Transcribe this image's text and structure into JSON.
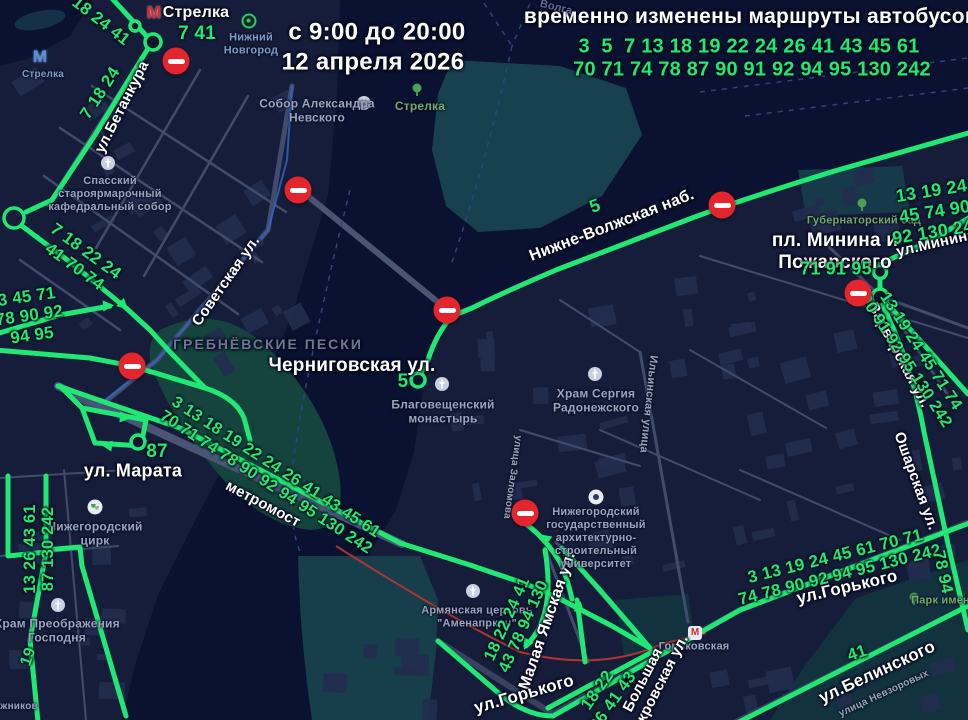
{
  "header": {
    "time_from_to": "с 9:00 до 20:00",
    "date": "12 апреля 2026",
    "title": "временно изменены маршруты автобусов",
    "routes_changed_line1": "3  5  7 13 18 19 22 24 26 41 43 45 61",
    "routes_changed_line2": "70 71 74 78 87 90 91 92 94 95 130 242"
  },
  "metro": {
    "m_letter": "М",
    "strelka_top_label": "Стрелка",
    "strelka_station_label": "Стрелка",
    "gorkovskaya_label": "Горьковская"
  },
  "city": {
    "name_line1": "Нижний",
    "name_line2": "Новгород"
  },
  "streets": {
    "betankura": "ул.Бетанкура",
    "sovetskaya": "Советская ул.",
    "nizhnevolzhskaya": "Нижне-Волжская наб.",
    "chernigovskaya": "Черниговская ул.",
    "marata": "ул. Марата",
    "metromost": "метромост",
    "minin_square": [
      "пл. Минина и",
      "Пожарского"
    ],
    "minina": "ул.Минина",
    "varvarskaya": "Варварская ул.",
    "osharskaya": "Ошарская ул.",
    "malaya_yamskaya": "Малая Ямская ул.",
    "gorkogo": "ул.Горького",
    "gorkogo2": "ул.Горького",
    "bolshaya_pokrovskaya": [
      "Большая",
      "Покровская ул."
    ],
    "belinskogo": "ул.Белинского",
    "ilyinskaya": "Ильинская улица",
    "zalomova": "улица Заломова",
    "nevzorovykh": "улица Невзоровых",
    "ozhnikov": "ожников"
  },
  "pois": {
    "sobor_nevskogo": [
      "Собор Александра",
      "Невского"
    ],
    "strelka_park": "Стрелка",
    "spassky": [
      "Спасский",
      "староярмарочный",
      "кафедральный собор"
    ],
    "grebnevskie": "ГРЕБНЁВСКИЕ ПЕСКИ",
    "blagoveshchensky": [
      "Благовещенский",
      "монастырь"
    ],
    "sergiya": [
      "Храм Сергия",
      "Радонежского"
    ],
    "university": [
      "Нижегородский",
      "государственный",
      "архитектурно-",
      "строительный",
      "университет"
    ],
    "armenian": [
      "Армянская церковь",
      "\"Аменапркич\""
    ],
    "circus": [
      "Нижегородский",
      "цирк"
    ],
    "preobrazheniya": [
      "Храм Преображения",
      "Господня"
    ],
    "gubernatorsky": "Губернаторский сад",
    "park_imeni": "Парк имени",
    "volga": "Волга"
  },
  "route_numbers": {
    "strelka_entry": "18 24 41",
    "strelka_m": "7 41",
    "betankura_down": "7 18 24",
    "left_mid": [
      "7 18 22 24",
      "41 70 74"
    ],
    "left_low": [
      "3 45 71",
      "78 90 92",
      "94 95"
    ],
    "bridge": [
      "3 13 18 19 22 24 26 41 43 45 61",
      "70 71 74 78 90 92 94 95 130 242"
    ],
    "right_top": [
      "13 19 24",
      "45 74 90",
      "92 130 242"
    ],
    "minin_sq": "71 91 95",
    "varvarskaya": [
      "13 19 24 45 71 74",
      "90 91 92 95 130 242"
    ],
    "gorkogo": [
      "3 13 19 24 45 61 70 71",
      "74 78 90 92 94 95 130 242"
    ],
    "oshar": "78 94",
    "belinskogo": "41",
    "yamskaya": [
      "18 22 24 41",
      "43 78 94 130"
    ],
    "pokrovskaya": [
      "18 22",
      "26 41 43"
    ],
    "bottom_left": [
      "13 26 43 61",
      "87 130 242"
    ],
    "n19": "19",
    "n87": "87",
    "n5_terminal": "5",
    "n5_emb": "5"
  },
  "colors": {
    "route_green": "#1fe973",
    "sign_red": "#e5252d",
    "water": "#0b1130",
    "land": "#161d3a"
  }
}
